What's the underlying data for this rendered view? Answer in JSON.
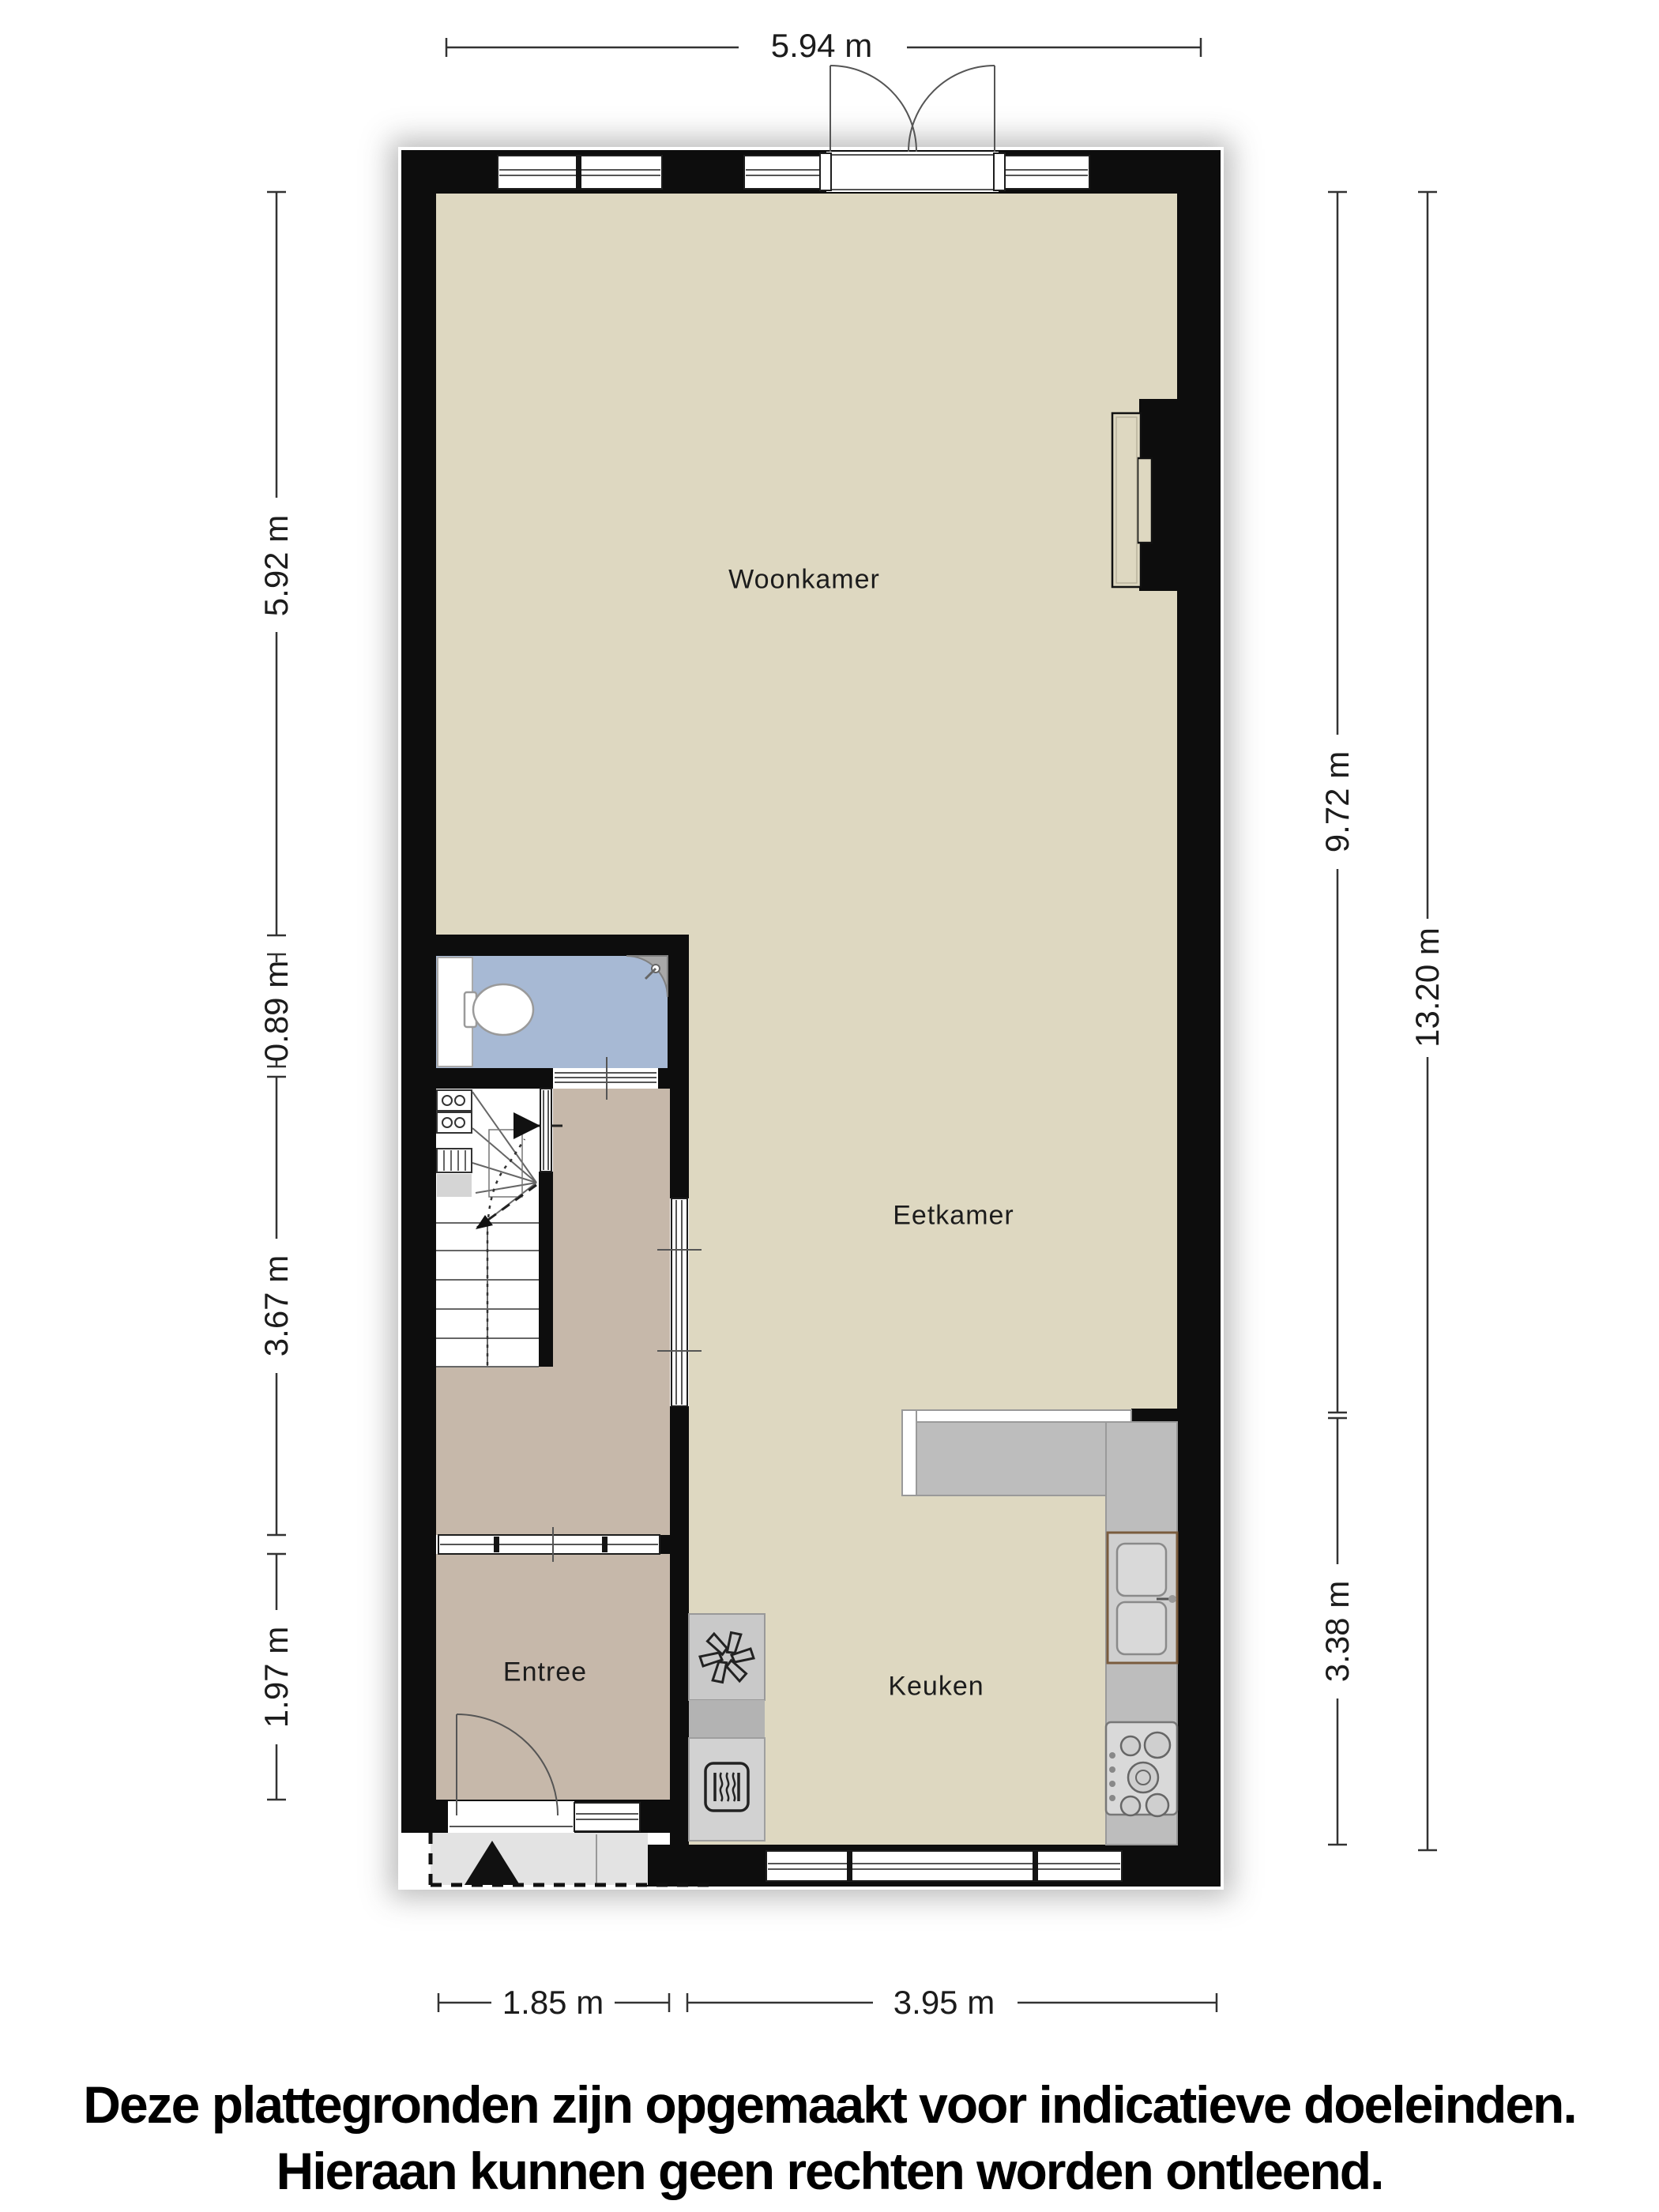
{
  "plan": {
    "rooms": {
      "woonkamer": "Woonkamer",
      "eetkamer": "Eetkamer",
      "keuken": "Keuken",
      "entree": "Entree"
    },
    "dimensions": {
      "top": "5.94 m",
      "left": [
        "5.92 m",
        "0.89 m",
        "3.67 m",
        "1.97 m"
      ],
      "right": [
        "9.72 m",
        "13.20 m",
        "3.38 m"
      ],
      "bottom": [
        "1.85 m",
        "3.95 m"
      ]
    },
    "disclaimer": [
      "Deze plattegronden zijn opgemaakt voor indicatieve doeleinden.",
      "Hieraan kunnen geen rechten worden ontleend."
    ],
    "icons": {
      "ventilation": "fan-icon",
      "heater": "heater-icon",
      "entrance_marker": "entrance-arrow-icon",
      "stair_direction": "stair-up-arrow-icon"
    },
    "colors": {
      "wall": "#0d0d0d",
      "floor_main": "#ded8c1",
      "floor_hall": "#c6b8aa",
      "floor_toilet": "#a7b9d4",
      "counter": "#bdbdbd",
      "counter_mid": "#b3b3b3",
      "counter_light": "#d2d2d2",
      "stoop": "#e3e3e3",
      "sink_border": "#7a5c3e",
      "dim": "#333333",
      "text": "#1c1c1c"
    }
  }
}
